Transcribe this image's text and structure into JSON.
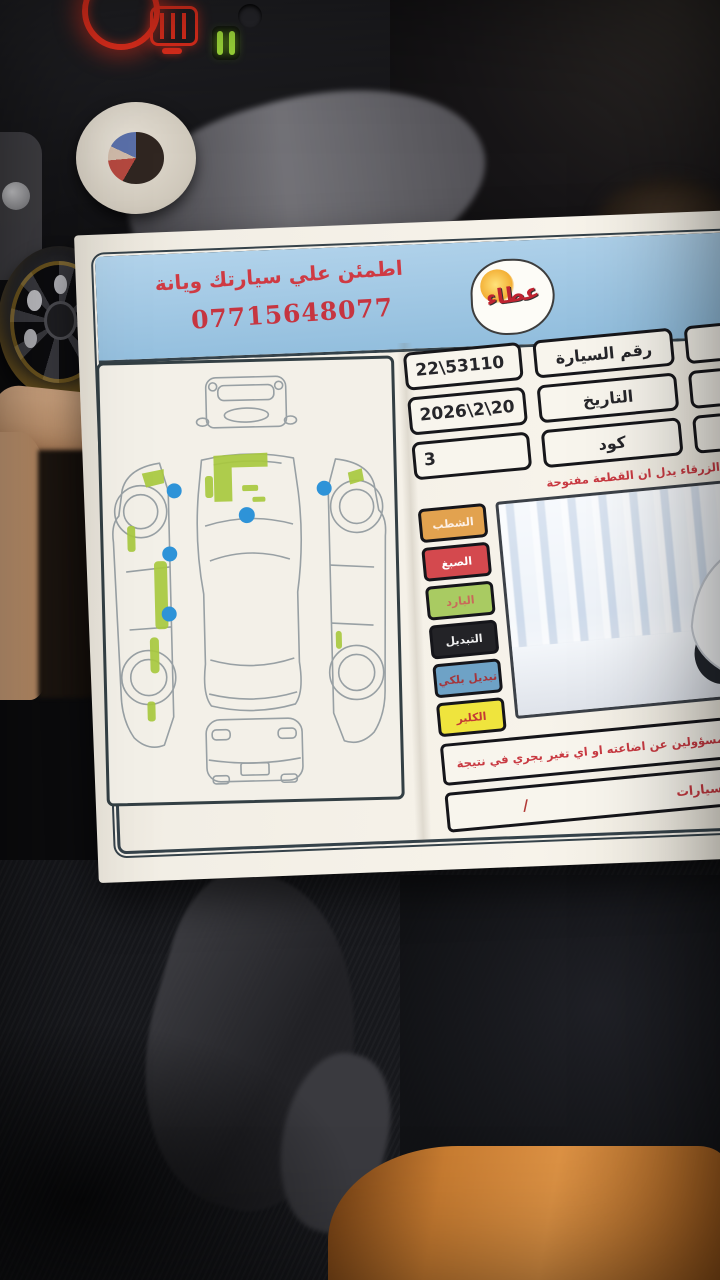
{
  "paper": {
    "banner": {
      "slogan": "اطمئن علي سيارتك ويانة",
      "phone": "07715648077",
      "logo_text": "عطاء",
      "right_line1": "العطاء",
      "right_line2": "حديثة"
    },
    "table": {
      "rows": [
        {
          "value": "22\\53110",
          "label": "رقم السيارة",
          "extra": "جمال حامد"
        },
        {
          "value": "2026\\2\\20",
          "label": "التاريخ",
          "extra": "سبورتج"
        },
        {
          "value": "3",
          "label": "كود",
          "extra": "ابيض"
        }
      ]
    },
    "note": "ملاحظة : وجود النقط الزرقاء يدل ان القطعة مفتوحة",
    "legend": [
      {
        "label": "الشطب",
        "color": "#e2a24f"
      },
      {
        "label": "الصبغ",
        "color": "#d4494e"
      },
      {
        "label": "البارد",
        "color": "#a9cb62"
      },
      {
        "label": "التبديل",
        "color": "#232327"
      },
      {
        "label": "تبديل بلكي",
        "color": "#6ea2c6"
      },
      {
        "label": "الكلير",
        "color": "#efe43d"
      }
    ],
    "photo": {
      "plate": "22"
    },
    "diagram": {
      "blue_dot_count": 5,
      "green_marked_areas": [
        "hood",
        "left-fender",
        "left-doors",
        "left-rocker",
        "right-fender"
      ],
      "colors": {
        "mark_green": "#a9c93f",
        "dot_blue": "#2e93d8"
      }
    },
    "disclaimer": "ما يسلم لحضرتكم ، لسنا مسؤولين عن اضاعته او اي تغير يجري في نتيجة",
    "dealer_row": {
      "label": "لمعارض السيارات",
      "value": "/"
    }
  },
  "scene": {
    "colors": {
      "banner_blue": "#9fc6e3",
      "red_text": "#cf3a43",
      "paper": "#f2eee5",
      "glow_red": "#e8301e",
      "indicator_green": "#a4e23c",
      "orange_fabric": "#c87c31"
    }
  }
}
